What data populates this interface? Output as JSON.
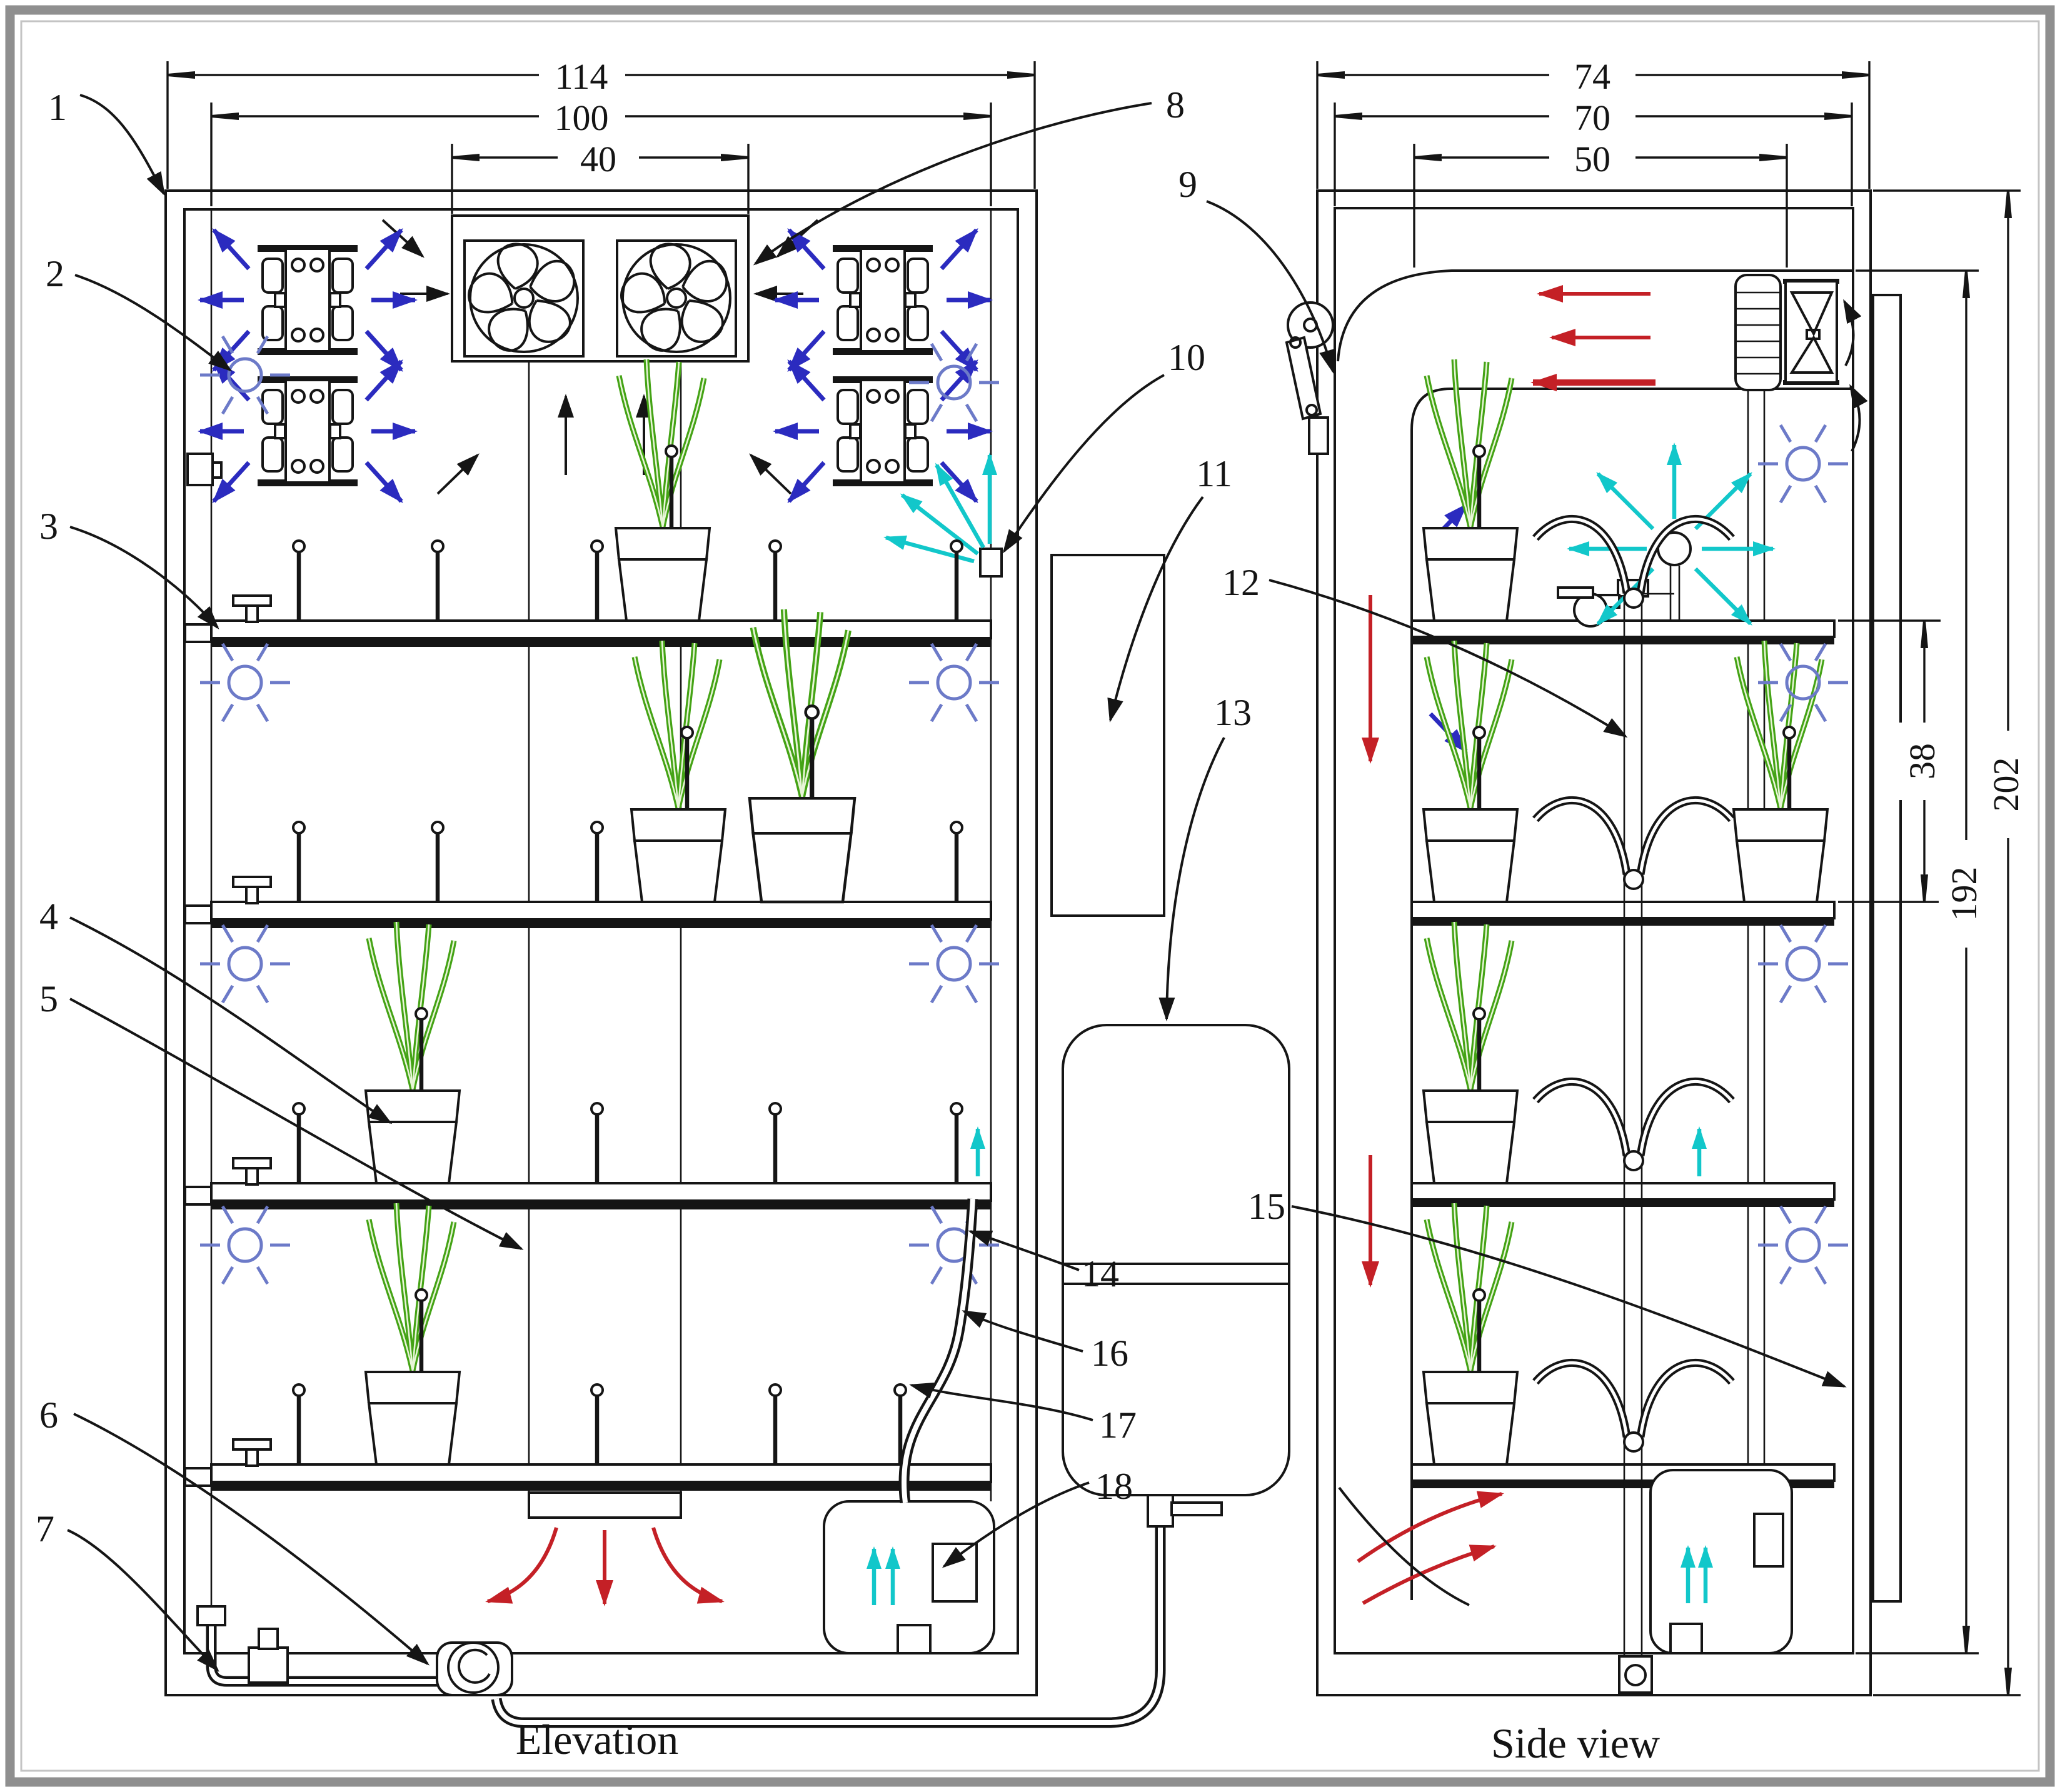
{
  "fig": {
    "caption_elevation": "Elevation",
    "caption_side": "Side view",
    "callouts": [
      "1",
      "2",
      "3",
      "4",
      "5",
      "6",
      "7",
      "8",
      "9",
      "10",
      "11",
      "12",
      "13",
      "14",
      "15",
      "16",
      "17",
      "18"
    ],
    "dims": {
      "el_total_w": "114",
      "el_inner_w": "100",
      "el_fan_w": "40",
      "sv_total_d": "74",
      "sv_inner_d": "70",
      "sv_plenum_d": "50",
      "sv_tier_gap": "38",
      "sv_inner_h": "192",
      "sv_total_h": "202"
    },
    "colors": {
      "line": "#151515",
      "blue_arrow": "#2b2bbf",
      "light_blue": "#6c7ac8",
      "cyan": "#12c7ca",
      "red": "#c42026",
      "green": "#44a315",
      "frame_gray": "#8f8f8f"
    }
  }
}
